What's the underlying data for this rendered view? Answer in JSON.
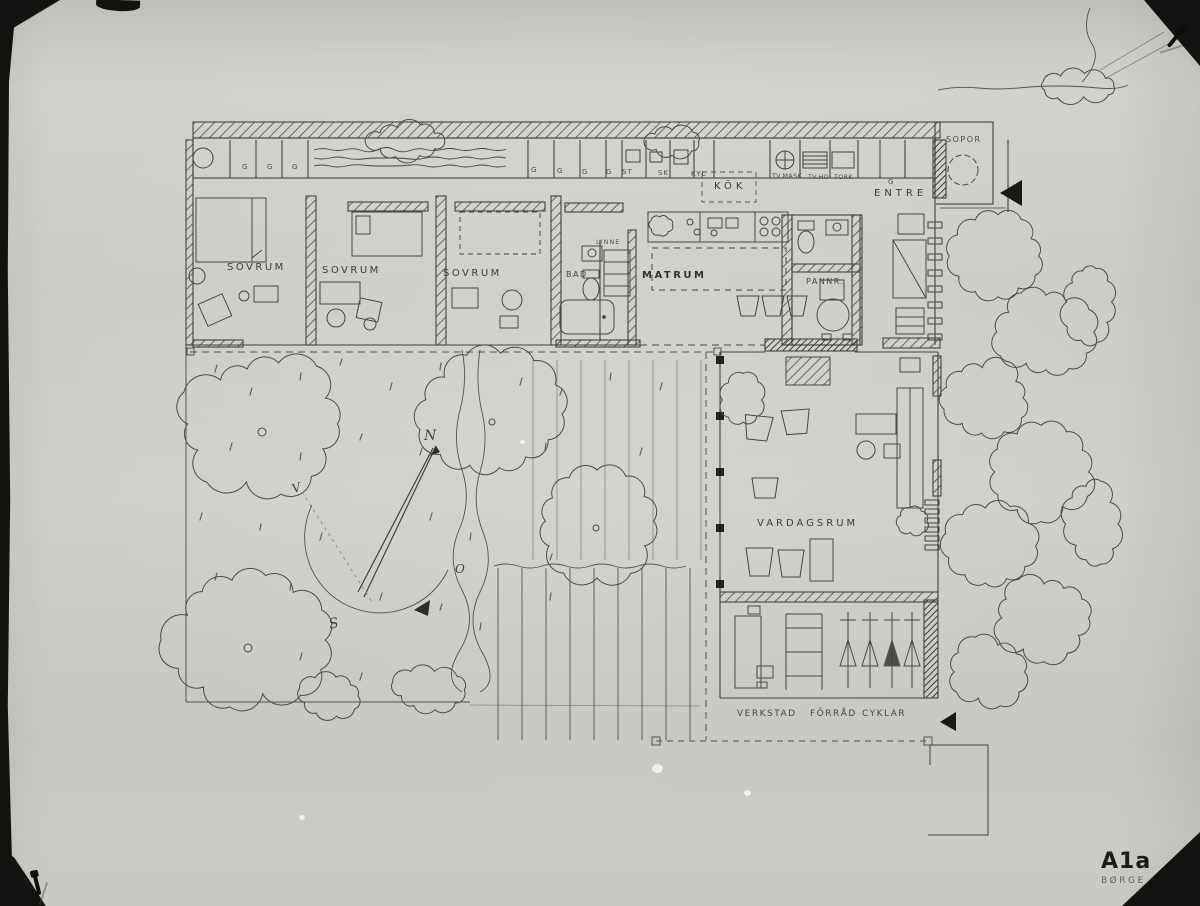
{
  "titleblock": {
    "sheet_code": "A1a",
    "architect": "BØRGE GL"
  },
  "rooms": {
    "sovrum_1": "SOVRUM",
    "sovrum_2": "SOVRUM",
    "sovrum_3": "SOVRUM",
    "bad": "BAD",
    "linne": "LINNE",
    "matrum": "MATRUM",
    "kok": "KÖK",
    "pannr": "PANNR.",
    "entre": "ENTRE",
    "sopor": "SOPOR",
    "vardagsrum": "VARDAGSRUM",
    "verkstad": "VERKSTAD",
    "forrad": "FÖRRÅD",
    "cyklar": "CYKLAR"
  },
  "closet_marks": {
    "g": "G",
    "st": "ST",
    "sk": "SK",
    "kyl": "KYL",
    "tvmask": "TV.MASK.",
    "tvho": "TV.HO",
    "tork": "TORK"
  },
  "compass": {
    "north": "N",
    "west": "V",
    "east": "O",
    "south": "S"
  },
  "palette": {
    "ink": "#45423c",
    "paper": "#cbcbc6"
  }
}
